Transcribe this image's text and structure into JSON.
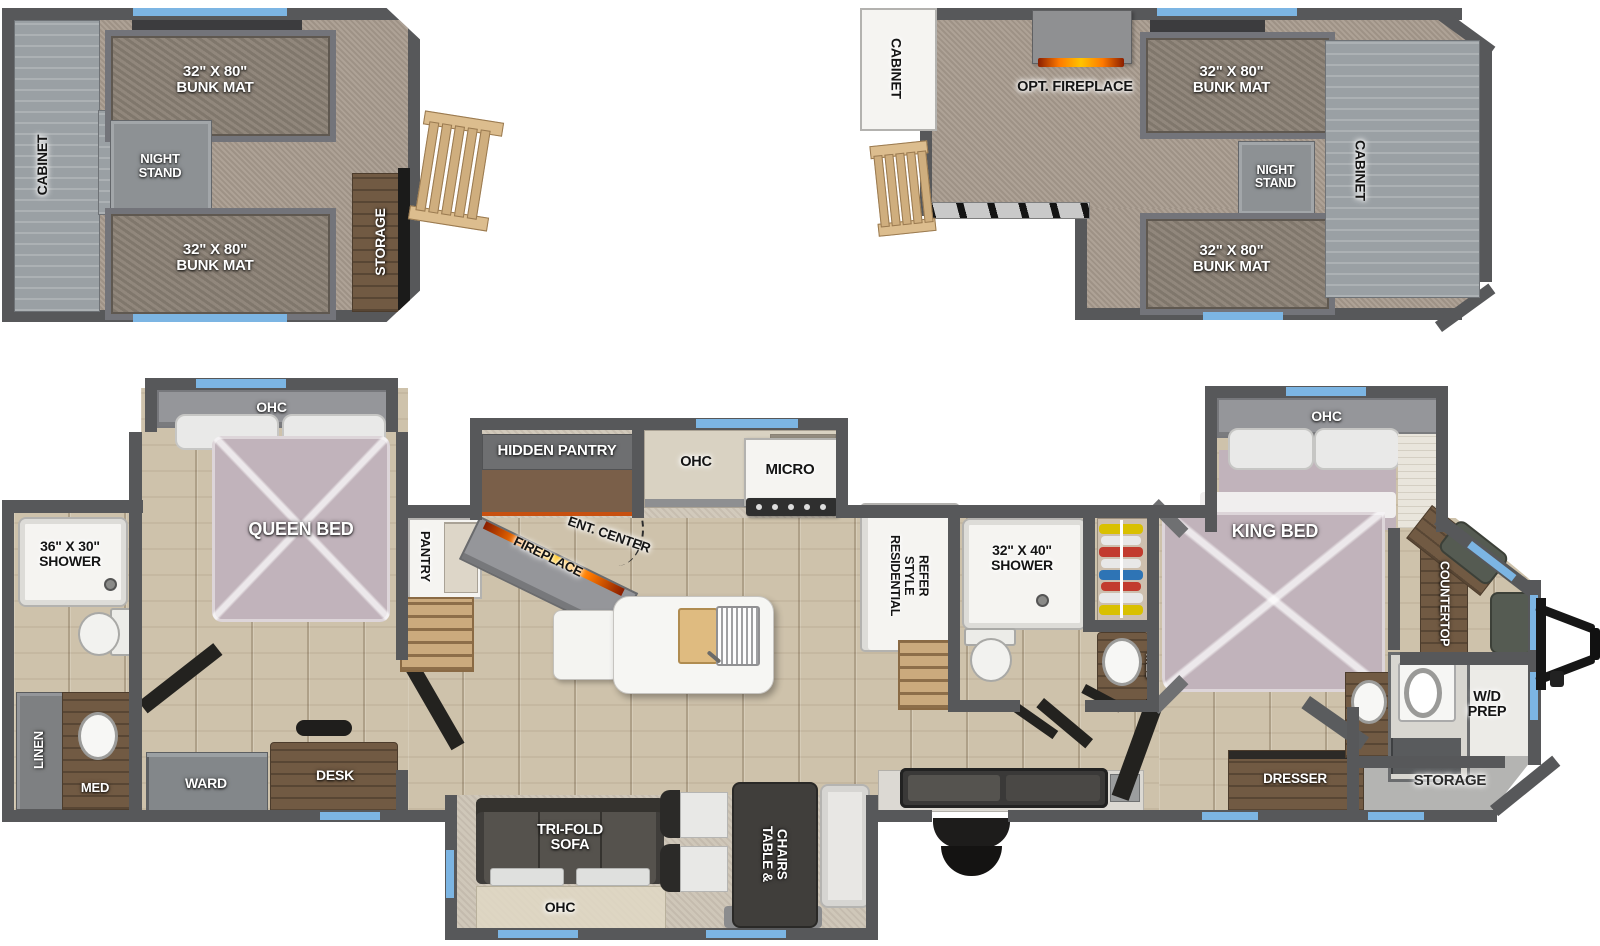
{
  "title": "RV floorplan with two loft plans and main floor",
  "colors": {
    "wall": "#57585a",
    "window_accent": "#7cb5e3",
    "wood_floor": "#cec2ab",
    "carpet": "#a89b8e",
    "bed": "#c1b3bb",
    "fireplace_glow": "#ff8a00"
  },
  "loft_left": {
    "cabinet": "CABINET",
    "bunk_top": "32\" X 80\"\nBUNK MAT",
    "night_stand": "NIGHT\nSTAND",
    "bunk_bottom": "32\" X 80\"\nBUNK MAT",
    "storage": "STORAGE"
  },
  "loft_right": {
    "cabinet_left": "CABINET",
    "opt_fireplace": "OPT. FIREPLACE",
    "bunk_top": "32\" X 80\"\nBUNK MAT",
    "night_stand": "NIGHT\nSTAND",
    "cabinet_right": "CABINET",
    "bunk_bottom": "32\" X 80\"\nBUNK MAT"
  },
  "main": {
    "rear_shower": "36\" X 30\"\nSHOWER",
    "linen": "LINEN",
    "med_rear": "MED",
    "ohc_queen": "OHC",
    "queen_bed": "QUEEN BED",
    "ward": "WARD",
    "desk": "DESK",
    "pantry": "PANTRY",
    "fireplace": "FIREPLACE",
    "ent_center": "ENT. CENTER",
    "hidden_pantry": "HIDDEN PANTRY",
    "ohc_kitchen": "OHC",
    "micro": "MICRO",
    "refer": "RESIDENTIAL\nSTYLE\nREFER",
    "mid_shower": "32\" X 40\"\nSHOWER",
    "med_mid": "MED",
    "ohc_king": "OHC",
    "king_bed": "KING BED",
    "dresser": "DRESSER",
    "countertop": "COUNTERTOP",
    "wd_prep": "W/D\nPREP",
    "storage_front": "STORAGE",
    "sofa": "TRI-FOLD\nSOFA",
    "ohc_sofa": "OHC",
    "table_chairs": "TABLE &\nCHAIRS"
  }
}
